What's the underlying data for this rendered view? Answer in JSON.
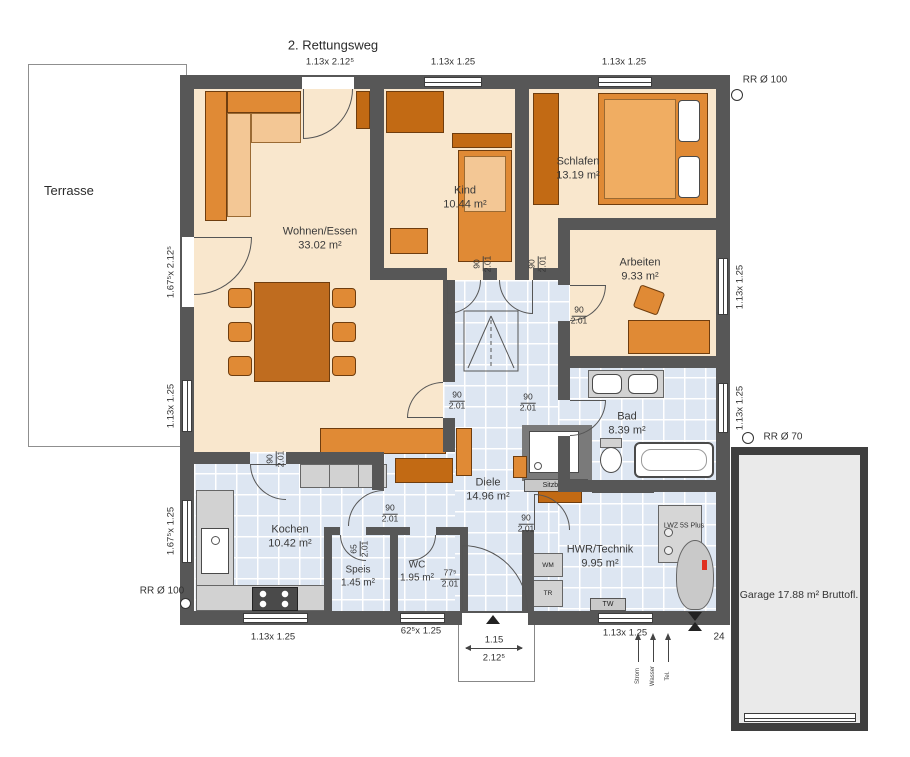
{
  "annotations": {
    "rescue_route": "2. Rettungsweg",
    "rr_top_right": "RR Ø 100",
    "rr_right": "RR Ø 70",
    "rr_bottom_left": "RR Ø 100",
    "corner_mark": "24"
  },
  "outdoor": {
    "terrace": "Terrasse",
    "garage": "Garage 17.88 m² Bruttofl."
  },
  "rooms": [
    {
      "name": "Wohnen/Essen",
      "area": "33.02 m²"
    },
    {
      "name": "Kind",
      "area": "10.44 m²"
    },
    {
      "name": "Schlafen",
      "area": "13.19 m²"
    },
    {
      "name": "Arbeiten",
      "area": "9.33 m²"
    },
    {
      "name": "Bad",
      "area": "8.39 m²"
    },
    {
      "name": "Diele",
      "area": "14.96 m²"
    },
    {
      "name": "Kochen",
      "area": "10.42 m²"
    },
    {
      "name": "Speis",
      "area": "1.45 m²"
    },
    {
      "name": "WC",
      "area": "1.95 m²"
    },
    {
      "name": "HWR/Technik",
      "area": "9.95 m²"
    }
  ],
  "windows": {
    "top_terrace_door": "1.13x 2.12⁵",
    "top_kind": "1.13x 1.25",
    "top_schlafen": "1.13x 1.25",
    "right_arbeiten": "1.13x 1.25",
    "right_bad": "1.13x 1.25",
    "left_terrace_door": "1.67⁵x 2.12⁵",
    "left_wohnen": "1.13x 1.25",
    "left_kochen": "1.67⁵x 1.25",
    "bottom_kochen": "1.13x 1.25",
    "bottom_wc": "62⁵x 1.25",
    "bottom_hwr": "1.13x 1.25",
    "entry_width": "1.15",
    "entry_height": "2.12⁵"
  },
  "doors": [
    {
      "w": "90",
      "h": "2.01"
    },
    {
      "w": "90",
      "h": "2.01"
    },
    {
      "w": "90",
      "h": "2.01"
    },
    {
      "w": "90",
      "h": "2.01"
    },
    {
      "w": "90",
      "h": "2.01"
    },
    {
      "w": "90",
      "h": "2.01"
    },
    {
      "w": "90",
      "h": "2.01"
    },
    {
      "w": "90",
      "h": "2.01"
    },
    {
      "w": "65",
      "h": "2.01"
    },
    {
      "w": "77⁵",
      "h": "2.01"
    }
  ],
  "fixtures": {
    "sitzbank": "Sitzbank",
    "el_telek": "El./ Telek.",
    "lwz": "LWZ 5S Plus",
    "wm": "WM",
    "tr": "TR",
    "tw": "TW"
  },
  "utilities": [
    "Strom",
    "Wasser",
    "Tel."
  ]
}
